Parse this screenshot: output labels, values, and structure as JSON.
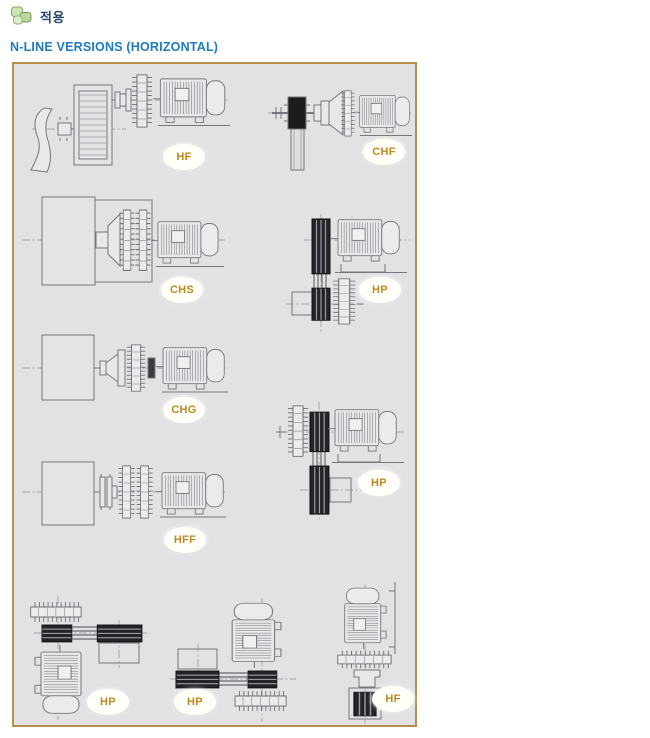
{
  "header": {
    "icon_name": "puzzle-leaf-icon",
    "section_label": "적용"
  },
  "title": "N-LINE VERSIONS (HORIZONTAL)",
  "panel": {
    "name": "n-line-horizontal-version-diagrams",
    "diagrams": [
      {
        "code": "HF",
        "depicts": "fan, belt housing, coupling and horizontal motor"
      },
      {
        "code": "CHF",
        "depicts": "shaft block, cone coupling and horizontal motor"
      },
      {
        "code": "CHS",
        "depicts": "fan casing, fluid coupling and horizontal motor"
      },
      {
        "code": "HP",
        "depicts": "horizontal motor with belt drive down to pulley"
      },
      {
        "code": "CHG",
        "depicts": "fan casing, gear coupling and horizontal motor"
      },
      {
        "code": "HP",
        "depicts": "coupling disc, horizontal motor, belt drive to lower pulley"
      },
      {
        "code": "HFF",
        "depicts": "fan casing, double flange coupling and horizontal motor"
      },
      {
        "code": "HP",
        "depicts": "vertical motor, top pulley, belt drive to fan box"
      },
      {
        "code": "HP",
        "depicts": "vertical motor, bottom pulley, belt drive to fan box"
      },
      {
        "code": "HF",
        "depicts": "vertical motor, coupling and axial fan below"
      }
    ]
  },
  "colors": {
    "title_blue": "#1e7bbf",
    "header_navy": "#28486a",
    "label_gold": "#bd8a1f",
    "panel_border": "#b3904a",
    "panel_bg": "#e2e2e4",
    "drawing_line": "#76767c",
    "drawing_dark": "#242428"
  }
}
